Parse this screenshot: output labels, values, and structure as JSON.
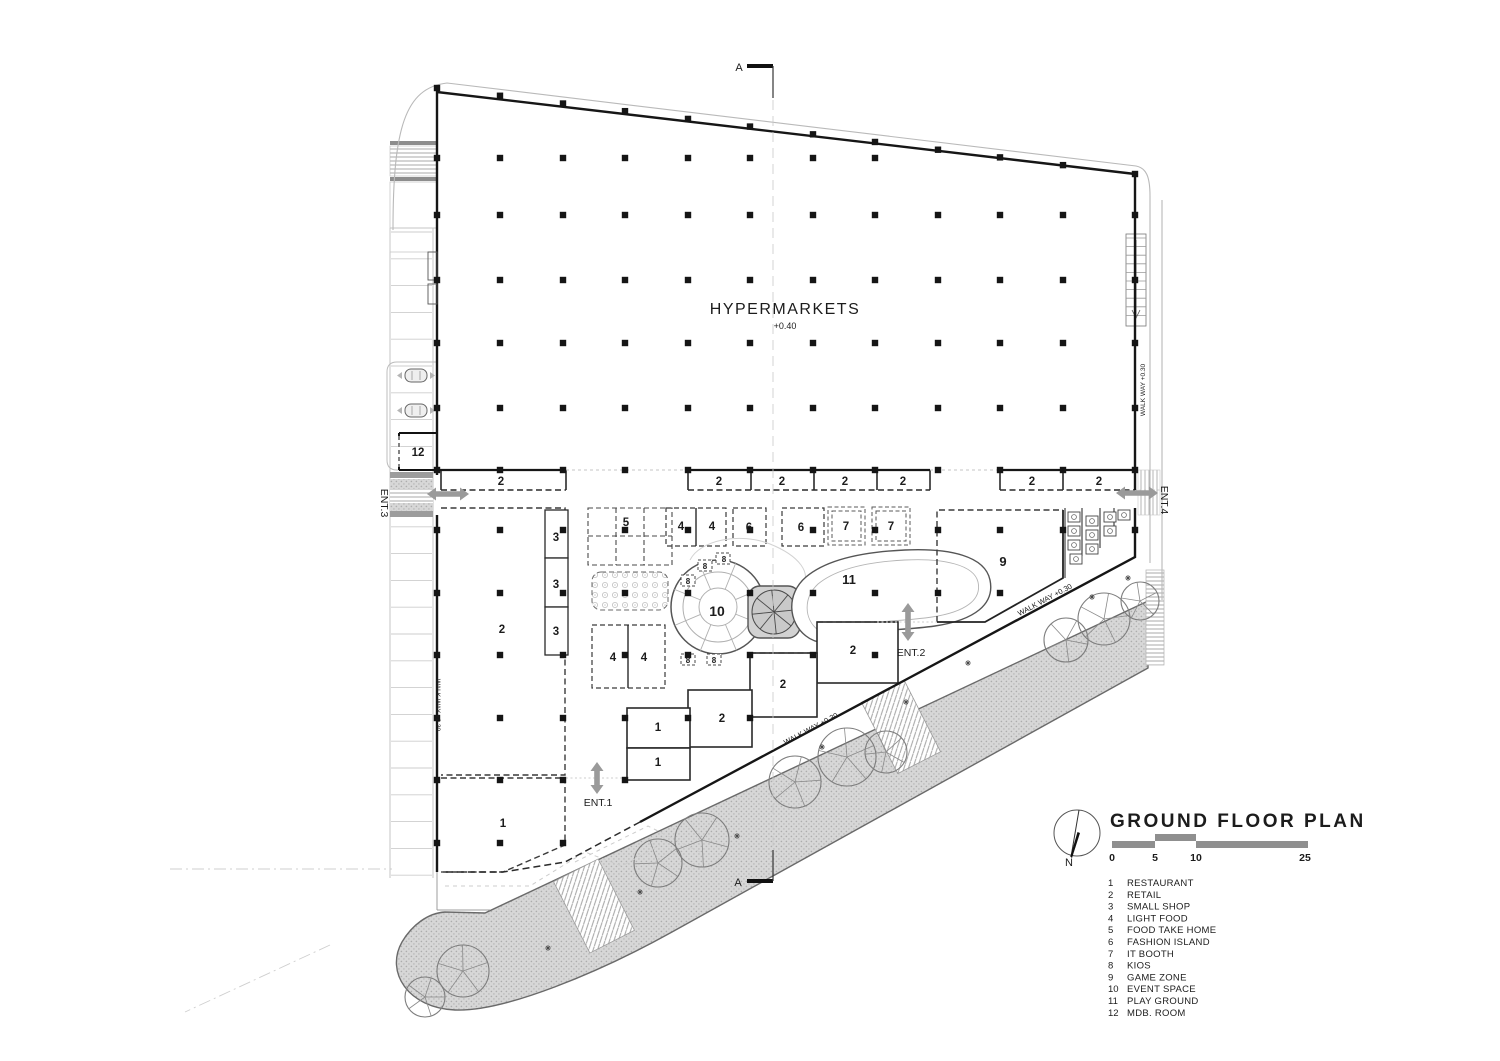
{
  "plan": {
    "hall_label": "HYPERMARKETS",
    "hall_level": "+0.40",
    "walkway_label": "WALK WAY  +0.30",
    "section_label": "A",
    "entrance_labels": {
      "e1": "ENT.1",
      "e2": "ENT.2",
      "e3": "ENT.3",
      "e4": "ENT.4"
    }
  },
  "legend": {
    "title": "GROUND FLOOR PLAN",
    "north_label": "N",
    "scale_ticks": [
      "0",
      "5",
      "10",
      "25"
    ],
    "items": [
      {
        "num": "1",
        "label": "RESTAURANT"
      },
      {
        "num": "2",
        "label": "RETAIL"
      },
      {
        "num": "3",
        "label": "SMALL SHOP"
      },
      {
        "num": "4",
        "label": "LIGHT FOOD"
      },
      {
        "num": "5",
        "label": "FOOD TAKE HOME"
      },
      {
        "num": "6",
        "label": "FASHION ISLAND"
      },
      {
        "num": "7",
        "label": "IT BOOTH"
      },
      {
        "num": "8",
        "label": "KIOS"
      },
      {
        "num": "9",
        "label": "GAME ZONE"
      },
      {
        "num": "10",
        "label": "EVENT SPACE"
      },
      {
        "num": "11",
        "label": "PLAY GROUND"
      },
      {
        "num": "12",
        "label": "MDB. ROOM"
      }
    ]
  },
  "room_labels": [
    {
      "t": "2",
      "x": 501,
      "y": 485
    },
    {
      "t": "2",
      "x": 719,
      "y": 485
    },
    {
      "t": "2",
      "x": 782,
      "y": 485
    },
    {
      "t": "2",
      "x": 845,
      "y": 485
    },
    {
      "t": "2",
      "x": 903,
      "y": 485
    },
    {
      "t": "2",
      "x": 1032,
      "y": 485
    },
    {
      "t": "2",
      "x": 1099,
      "y": 485
    },
    {
      "t": "12",
      "x": 418,
      "y": 456
    },
    {
      "t": "2",
      "x": 502,
      "y": 633
    },
    {
      "t": "3",
      "x": 556,
      "y": 541
    },
    {
      "t": "3",
      "x": 556,
      "y": 588
    },
    {
      "t": "3",
      "x": 556,
      "y": 635
    },
    {
      "t": "1",
      "x": 503,
      "y": 827
    },
    {
      "t": "5",
      "x": 626,
      "y": 526
    },
    {
      "t": "4",
      "x": 681,
      "y": 530
    },
    {
      "t": "4",
      "x": 712,
      "y": 530
    },
    {
      "t": "6",
      "x": 749,
      "y": 531
    },
    {
      "t": "6",
      "x": 801,
      "y": 531
    },
    {
      "t": "7",
      "x": 846,
      "y": 530
    },
    {
      "t": "7",
      "x": 891,
      "y": 530
    },
    {
      "t": "4",
      "x": 613,
      "y": 661
    },
    {
      "t": "4",
      "x": 644,
      "y": 661
    },
    {
      "t": "10",
      "x": 717,
      "y": 616,
      "fs": 14
    },
    {
      "t": "11",
      "x": 849,
      "y": 584,
      "fs": 13
    },
    {
      "t": "9",
      "x": 1003,
      "y": 566,
      "fs": 13
    },
    {
      "t": "8",
      "x": 688,
      "y": 584,
      "fs": 8
    },
    {
      "t": "8",
      "x": 705,
      "y": 569,
      "fs": 8
    },
    {
      "t": "8",
      "x": 724,
      "y": 562,
      "fs": 8
    },
    {
      "t": "8",
      "x": 688,
      "y": 663,
      "fs": 8
    },
    {
      "t": "8",
      "x": 714,
      "y": 663,
      "fs": 8
    },
    {
      "t": "2",
      "x": 853,
      "y": 654
    },
    {
      "t": "2",
      "x": 783,
      "y": 688
    },
    {
      "t": "2",
      "x": 722,
      "y": 722
    },
    {
      "t": "1",
      "x": 658,
      "y": 731
    },
    {
      "t": "1",
      "x": 658,
      "y": 766
    }
  ],
  "colors": {
    "wall": "#1c1c1c",
    "dash": "#3a3a3a",
    "light": "#bcbcbc",
    "gray_fill": "#d6d6d6",
    "arrow": "#9a9a9a"
  }
}
